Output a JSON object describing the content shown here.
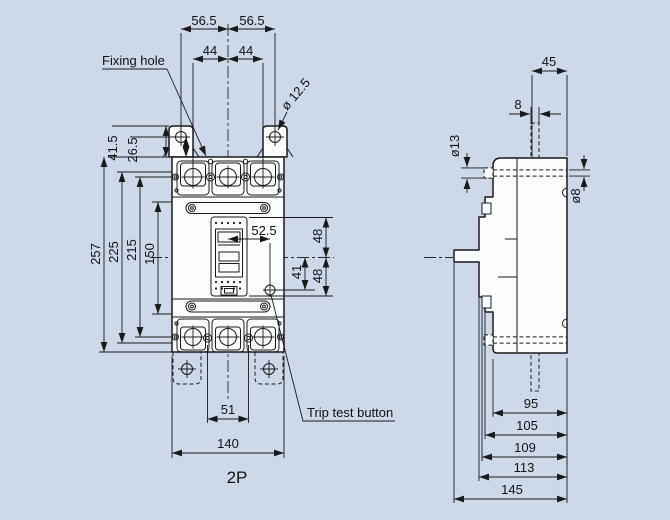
{
  "labels": {
    "fixing_hole": "Fixing hole",
    "trip_test": "Trip test button",
    "pole": "2P"
  },
  "front_view_dims": {
    "tab_span_left": "56.5",
    "tab_span_right": "56.5",
    "terminal_pitch_left": "44",
    "terminal_pitch_right": "44",
    "fixing_hole_dia": "ø 12.5",
    "tab_height": "41.5",
    "tab_hole_offset": "26.5",
    "overall_height": "257",
    "mount_height_outer": "225",
    "mount_height_inner": "215",
    "cover_height": "150",
    "handle_to_button": "52.5",
    "upper_offset": "48",
    "button_offset": "41",
    "lower_offset": "48",
    "bottom_screw_span": "51",
    "overall_width": "140"
  },
  "side_view_dims": {
    "top_depth": "45",
    "stud_width": "8",
    "bolt_head_dia": "ø13",
    "bolt_shaft_dia": "ø8",
    "depth_95": "95",
    "depth_105": "105",
    "depth_109": "109",
    "depth_113": "113",
    "depth_145": "145"
  },
  "colors": {
    "background": "#cdd8ea",
    "line": "#1a1a1a",
    "body_fill": "#fbfcfd"
  }
}
